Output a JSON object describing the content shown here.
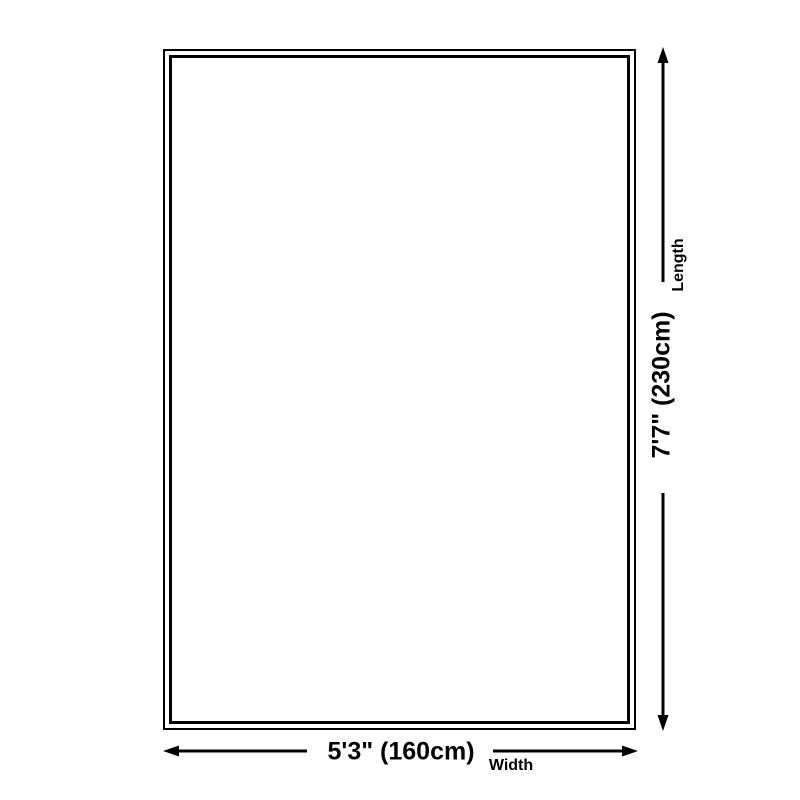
{
  "page": {
    "background": "#ffffff"
  },
  "diagram": {
    "type": "product-dimension-diagram",
    "line_color": "#000000",
    "rug": {
      "shape": "rectangle",
      "border_style": "double",
      "border_color": "#000000",
      "fill": "#ffffff"
    },
    "length": {
      "value": "7'7\" (230cm)",
      "label": "Length"
    },
    "width": {
      "value": "5'3\" (160cm)",
      "label": "Width"
    }
  }
}
